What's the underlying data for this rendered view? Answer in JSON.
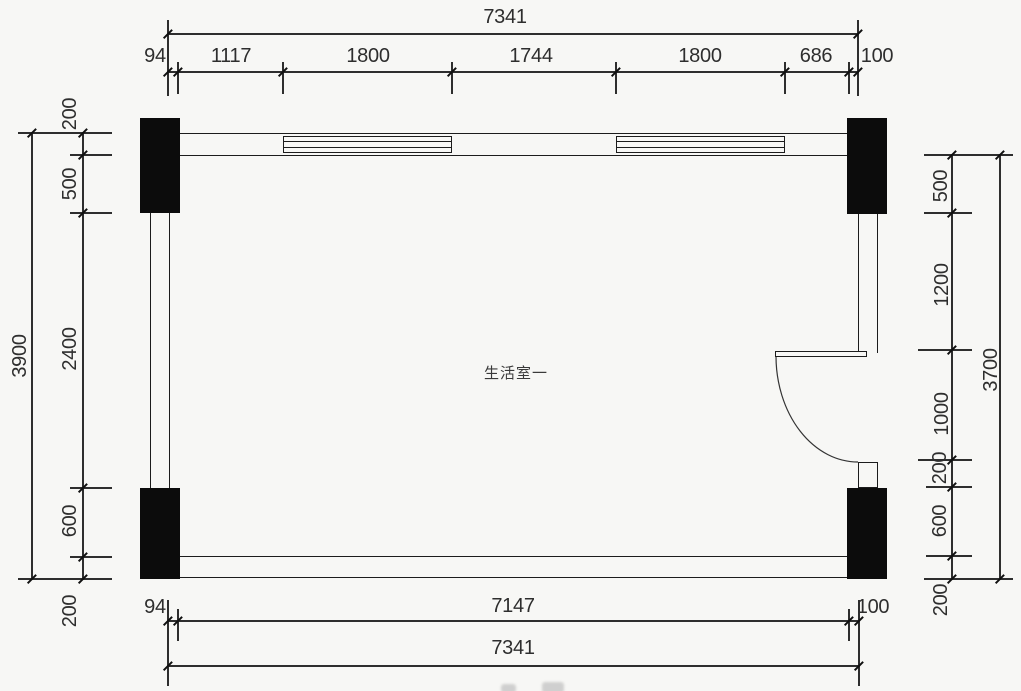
{
  "room": {
    "label": "生活室一"
  },
  "dimensions": {
    "top": {
      "overall": "7341",
      "segments": [
        "94",
        "1117",
        "1800",
        "1744",
        "1800",
        "686",
        "100"
      ]
    },
    "bottom": {
      "overall": "7341",
      "segments": [
        "94",
        "7147",
        "100"
      ]
    },
    "left": {
      "overall": "3900",
      "segments": [
        "200",
        "500",
        "2400",
        "600",
        "200"
      ]
    },
    "right": {
      "overall": "3700",
      "segments": [
        "500",
        "1200",
        "1000",
        "200",
        "600",
        "200"
      ]
    }
  },
  "colors": {
    "line": "#2e2e2e",
    "wall": "#1c1c1c",
    "column": "#0c0c0c",
    "background": "#f7f7f5",
    "text": "#2e2e2e"
  }
}
